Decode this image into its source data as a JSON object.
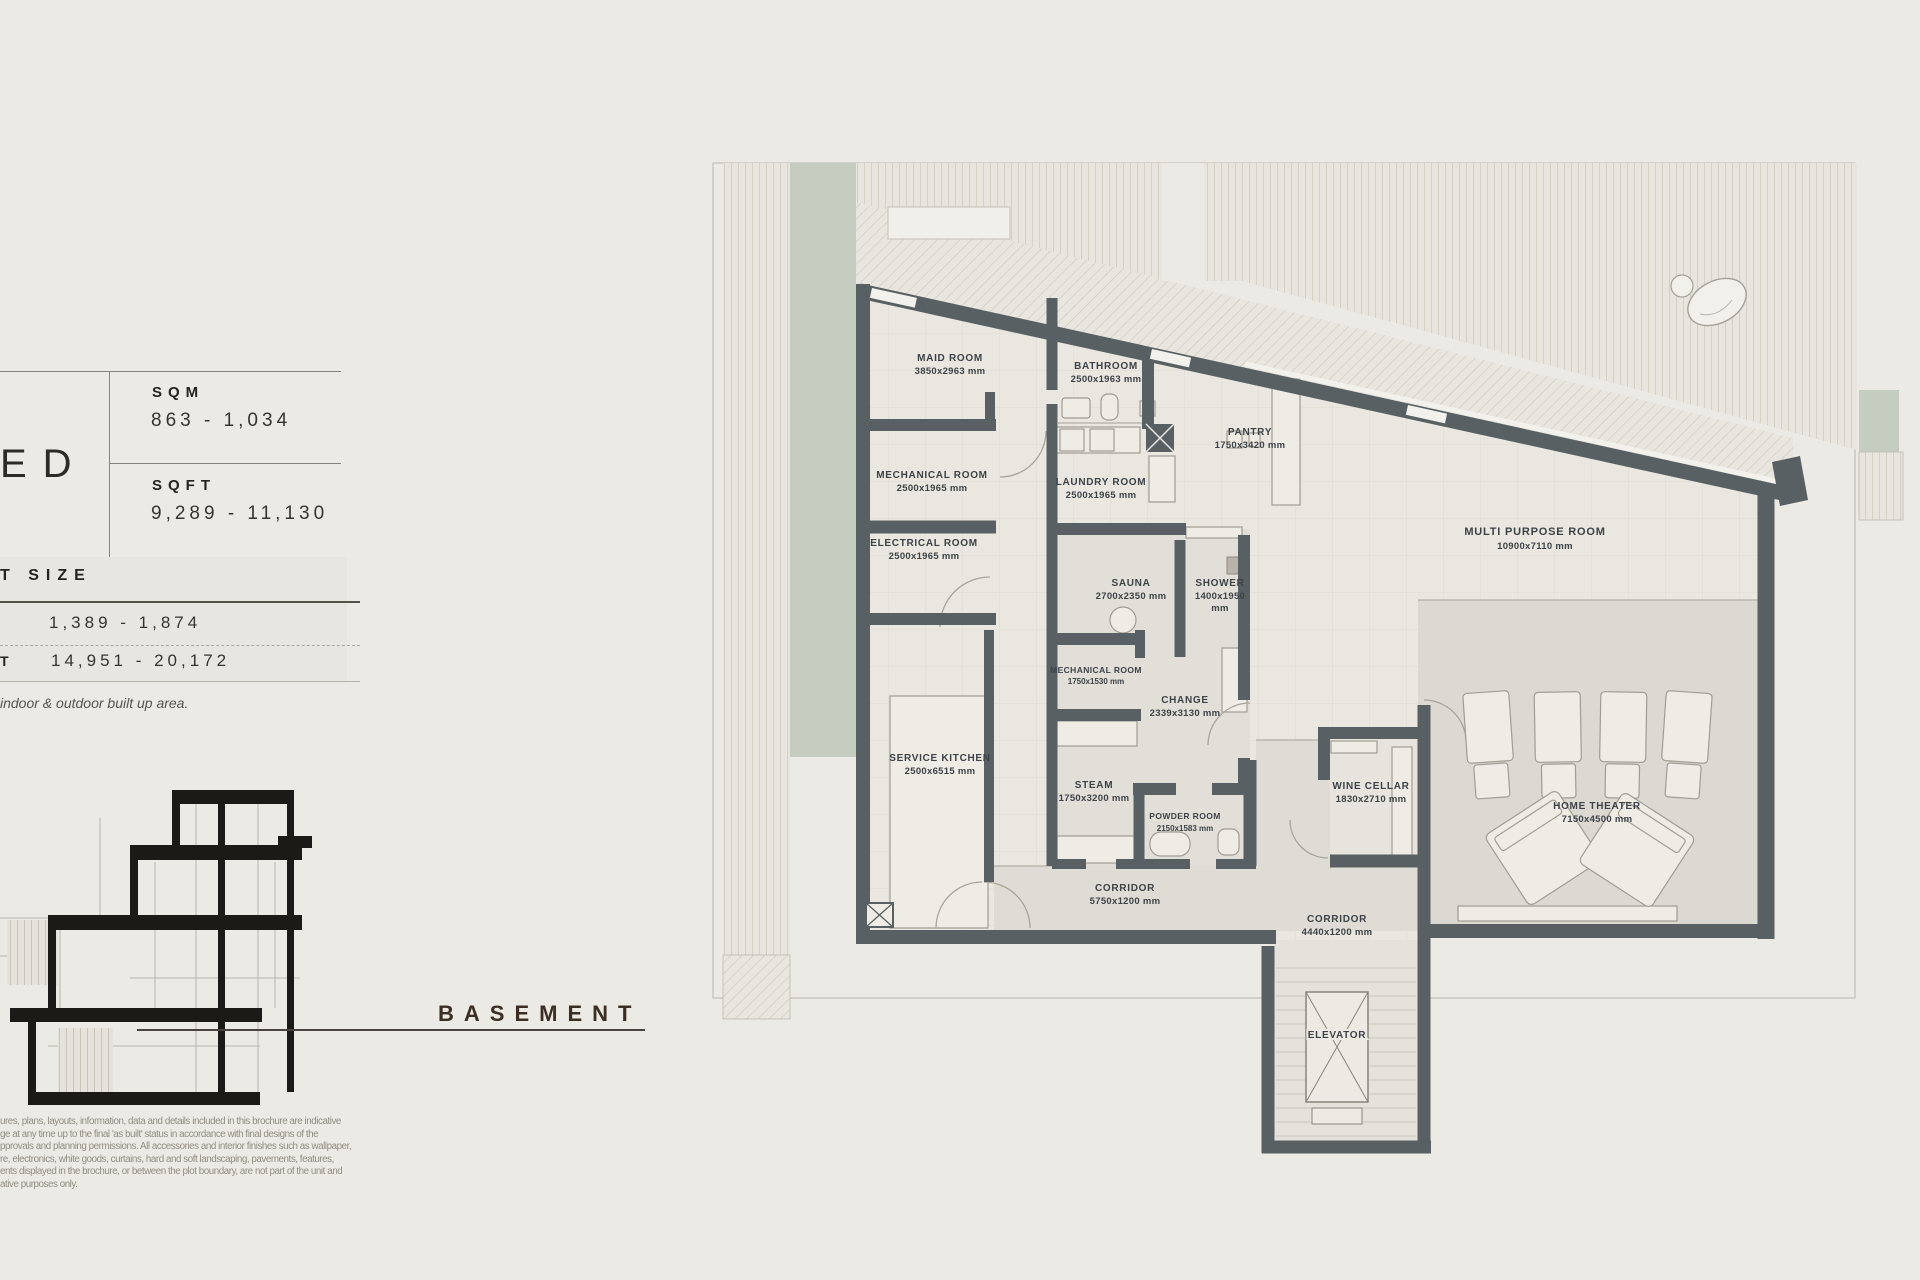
{
  "panel": {
    "unit_label_fragment": "ED",
    "area_table": {
      "sqm_label": "SQM",
      "sqm_value": "863 - 1,034",
      "sqft_label": "SQFT",
      "sqft_value": "9,289 - 11,130"
    },
    "plot_size": {
      "header_fragment": "T SIZE",
      "row1_value": "1,389 - 1,874",
      "row2_label_fragment": "T",
      "row2_value": "14,951 - 20,172"
    },
    "note_fragment": "indoor & outdoor built up area.",
    "floor_label": "BASEMENT",
    "disclaimer_lines": [
      "ures, plans, layouts, information, data and details included in this brochure are indicative",
      "ge at any time up to the final 'as built' status in accordance with final designs of the",
      "pprovals and planning permissions. All accessories and interior finishes such as wallpaper,",
      "re, electronics, white goods, curtains, hard and soft landscaping, pavements, features,",
      "ents displayed in the brochure, or between the plot boundary, are not part of the unit and",
      "ative purposes only."
    ]
  },
  "plan": {
    "rooms": [
      {
        "name": "MAID ROOM",
        "dims": "3850x2963 mm"
      },
      {
        "name": "BATHROOM",
        "dims": "2500x1963 mm"
      },
      {
        "name": "MECHANICAL ROOM",
        "dims": "2500x1965 mm"
      },
      {
        "name": "LAUNDRY ROOM",
        "dims": "2500x1965 mm"
      },
      {
        "name": "PANTRY",
        "dims": "1750x3420 mm"
      },
      {
        "name": "ELECTRICAL ROOM",
        "dims": "2500x1965 mm"
      },
      {
        "name": "SAUNA",
        "dims": "2700x2350 mm"
      },
      {
        "name": "SHOWER",
        "dims": "1400x1950",
        "dims2": "mm"
      },
      {
        "name": "MECHANICAL ROOM",
        "dims": "1750x1530 mm"
      },
      {
        "name": "CHANGE",
        "dims": "2339x3130 mm"
      },
      {
        "name": "SERVICE KITCHEN",
        "dims": "2500x6515 mm"
      },
      {
        "name": "STEAM",
        "dims": "1750x3200 mm"
      },
      {
        "name": "POWDER ROOM",
        "dims": "2150x1583 mm"
      },
      {
        "name": "CORRIDOR",
        "dims": "5750x1200 mm"
      },
      {
        "name": "MULTI PURPOSE ROOM",
        "dims": "10900x7110 mm"
      },
      {
        "name": "WINE CELLAR",
        "dims": "1830x2710 mm"
      },
      {
        "name": "HOME THEATER",
        "dims": "7150x4500 mm"
      },
      {
        "name": "CORRIDOR",
        "dims": "4440x1200 mm"
      },
      {
        "name": "ELEVATOR",
        "dims": ""
      }
    ]
  },
  "colors": {
    "wall": "#596064",
    "landscape_green": "#c5ccc0",
    "floor": "#eae7e0",
    "label_text": "#3d4247",
    "basement_label": "#3b2e24"
  }
}
